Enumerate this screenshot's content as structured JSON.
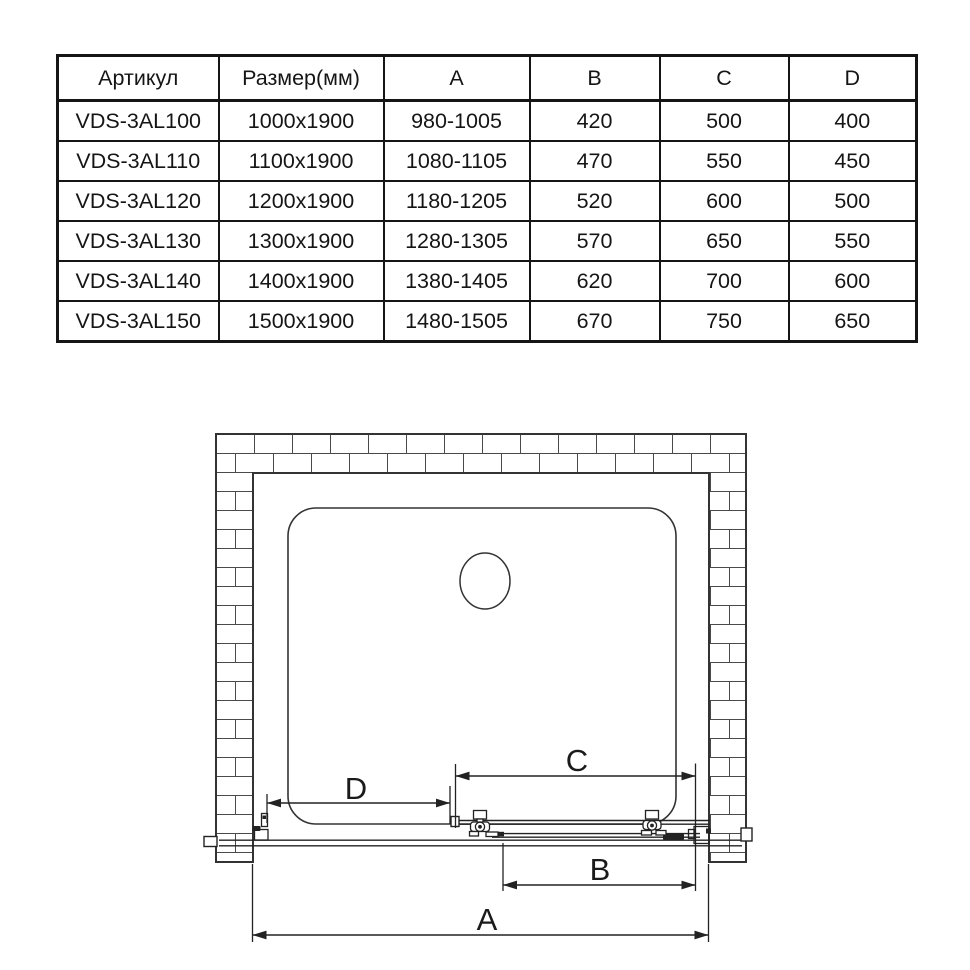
{
  "page": {
    "background": "#ffffff"
  },
  "table": {
    "headers": [
      "Артикул",
      "Размер(мм)",
      "A",
      "B",
      "C",
      "D"
    ],
    "rows": [
      {
        "cells": [
          "VDS-3AL100",
          "1000x1900",
          "980-1005",
          "420",
          "500",
          "400"
        ]
      },
      {
        "cells": [
          "VDS-3AL110",
          "1100x1900",
          "1080-1105",
          "470",
          "550",
          "450"
        ]
      },
      {
        "cells": [
          "VDS-3AL120",
          "1200x1900",
          "1180-1205",
          "520",
          "600",
          "500"
        ]
      },
      {
        "cells": [
          "VDS-3AL130",
          "1300x1900",
          "1280-1305",
          "570",
          "650",
          "550"
        ]
      },
      {
        "cells": [
          "VDS-3AL140",
          "1400x1900",
          "1380-1405",
          "620",
          "700",
          "600"
        ]
      },
      {
        "cells": [
          "VDS-3AL150",
          "1500x1900",
          "1480-1505",
          "670",
          "750",
          "650"
        ]
      }
    ]
  },
  "diagram": {
    "type": "technical-drawing",
    "description": "Top view of a sliding shower door installed in a brick niche: shower tray with drain, wall profiles, roller-mounted sliding panel and fixed panel, with dimension lines A, B, C, D",
    "dimension_labels": {
      "a": "A",
      "b": "B",
      "c": "C",
      "d": "D"
    },
    "colors": {
      "wall_line": "#333333",
      "hardware_line": "#222222",
      "dimension_line": "#222222",
      "text": "#1a1a1a",
      "background": "#ffffff"
    }
  }
}
